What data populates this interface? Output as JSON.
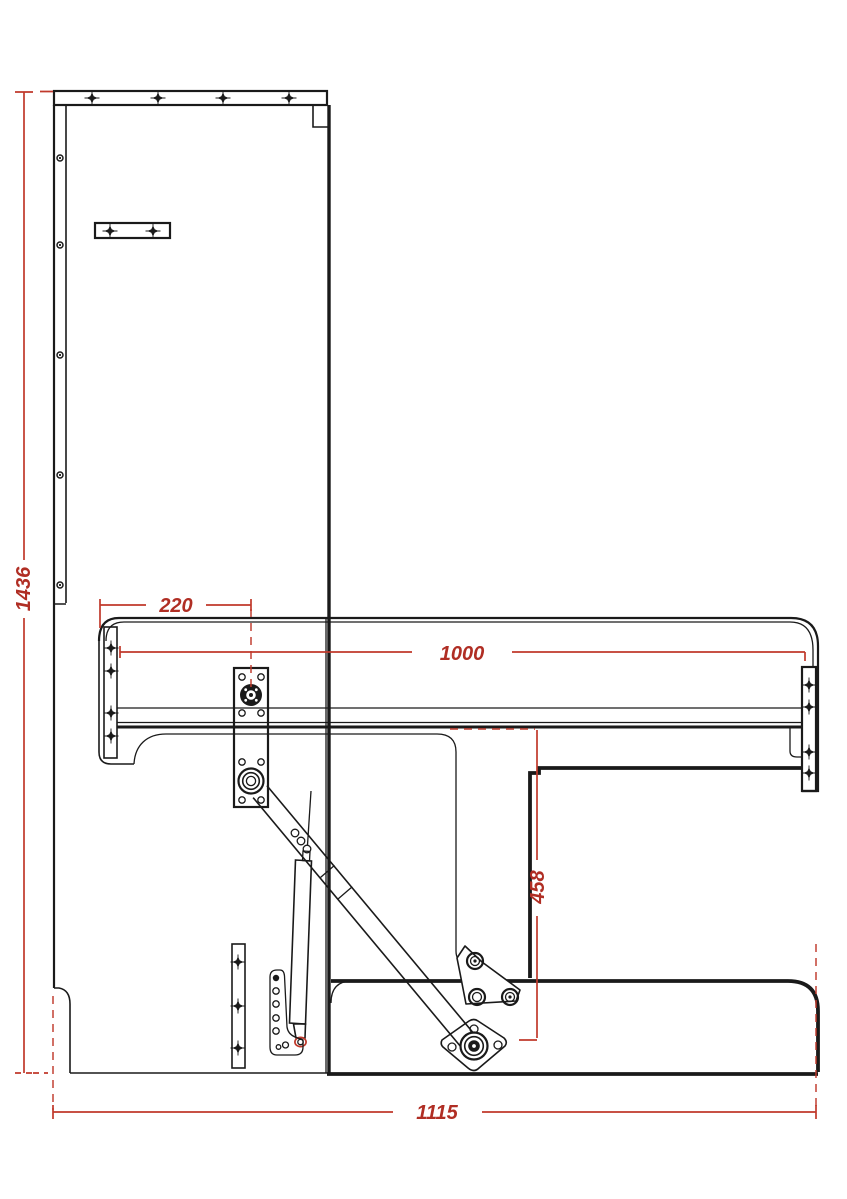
{
  "drawing": {
    "kind": "wall-bed mechanism side-view technical drawing",
    "dimensions": {
      "overall_height": {
        "label": "1436"
      },
      "pivot_offset": {
        "label": "220"
      },
      "frame_length": {
        "label": "1000"
      },
      "backrest_height": {
        "label": "458"
      },
      "overall_width": {
        "label": "1115"
      }
    },
    "colors": {
      "line": "#1a1a1a",
      "dimension_line": "#c0392b",
      "dimension_text": "#b02e24",
      "background": "#ffffff"
    }
  }
}
